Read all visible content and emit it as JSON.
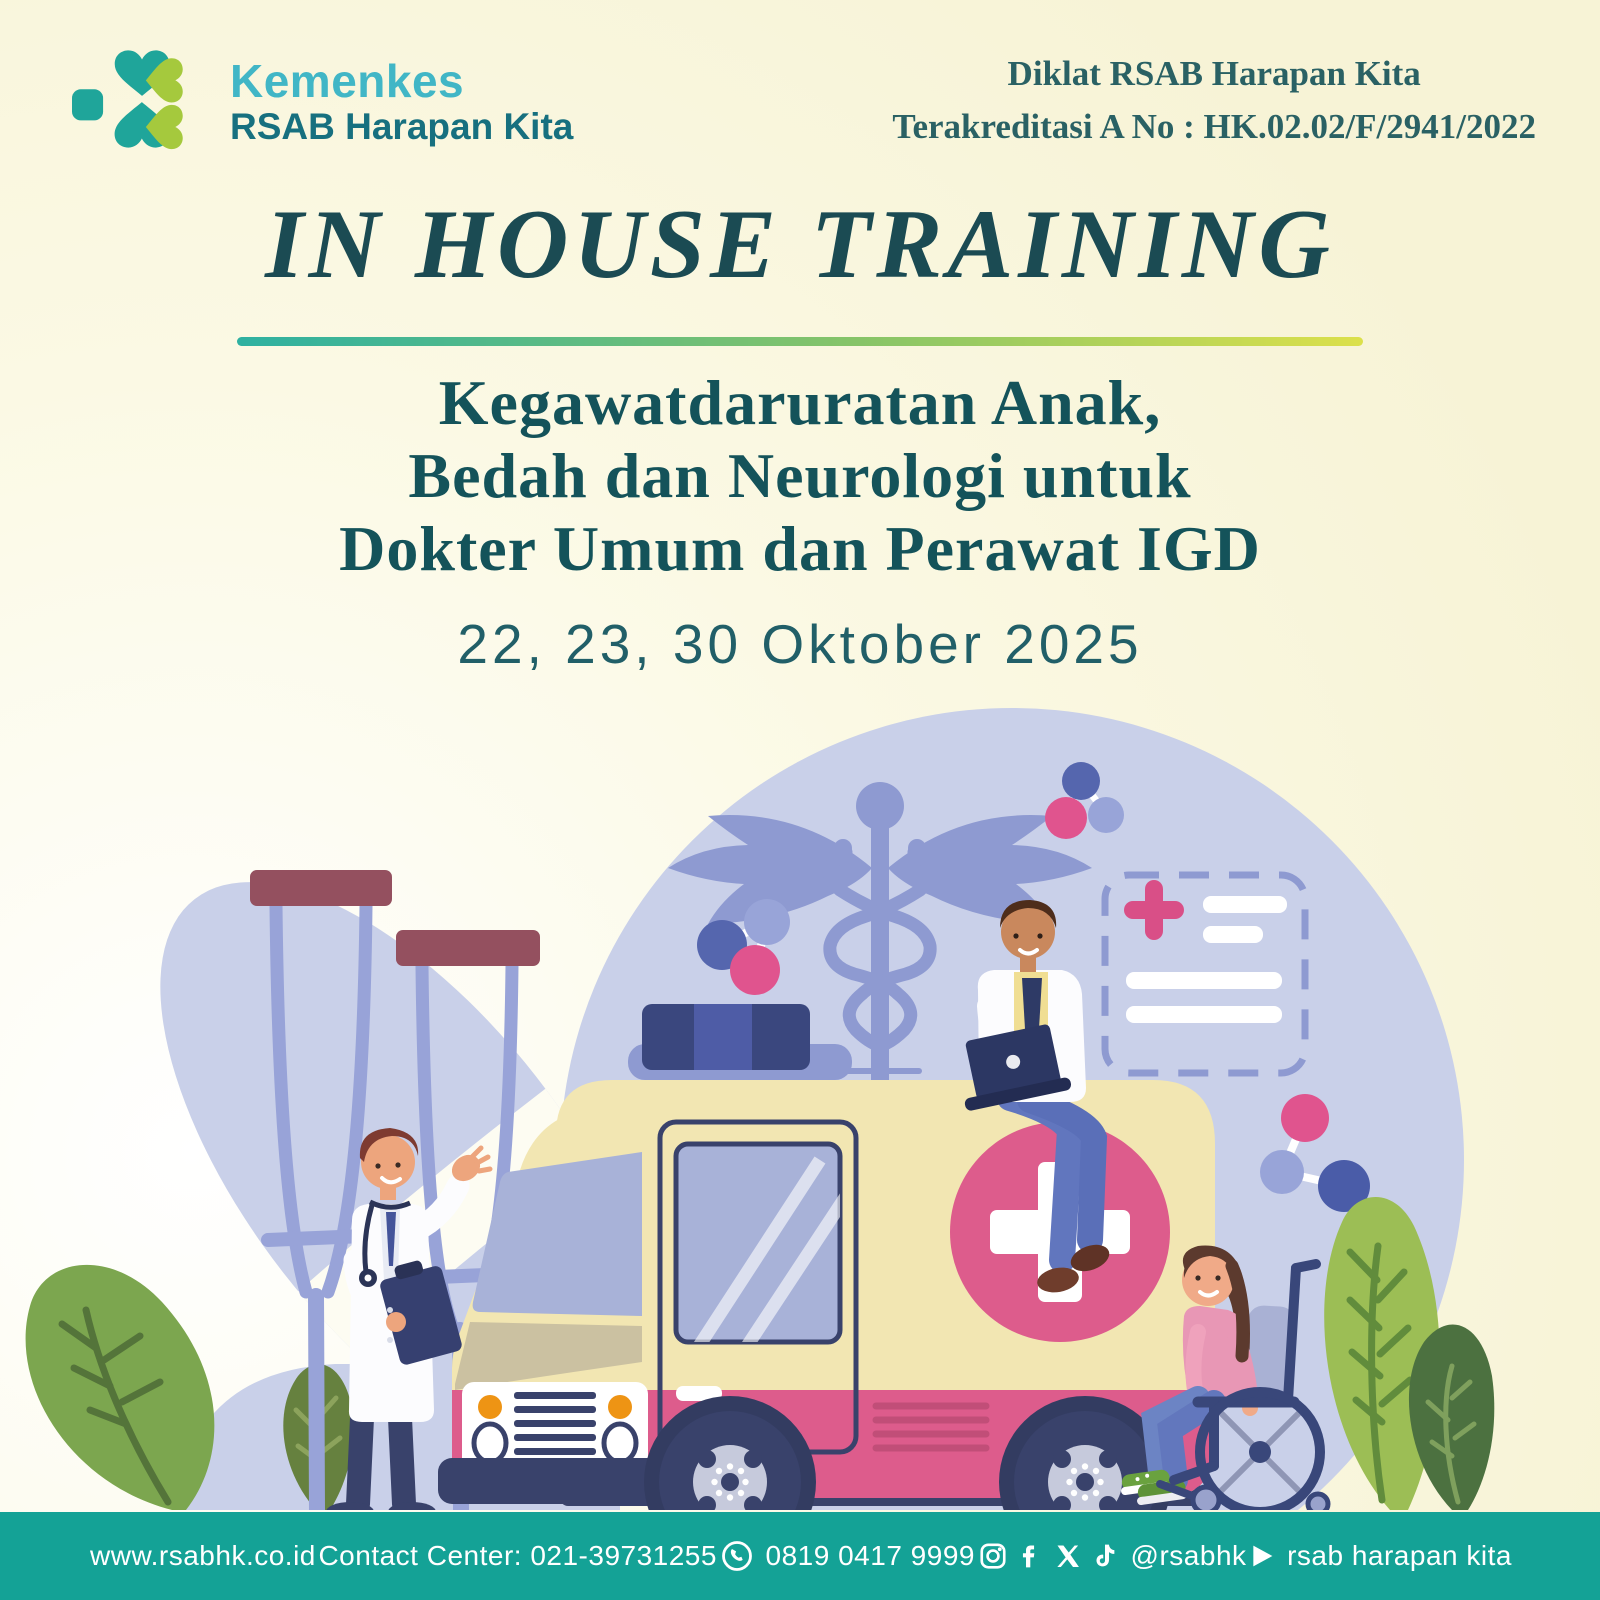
{
  "header": {
    "brand": {
      "line1": "Kemenkes",
      "line2": "RSAB Harapan Kita",
      "logo_icon": "kemenkes-clover-icon"
    },
    "accreditation_line1": "Diklat RSAB Harapan Kita",
    "accreditation_line2": "Terakreditasi A No : HK.02.02/F/2941/2022"
  },
  "title": "IN HOUSE TRAINING",
  "subtitle_lines": [
    "Kegawatdaruratan Anak,",
    "Bedah dan Neurologi untuk",
    "Dokter Umum dan Perawat IGD"
  ],
  "date": "22, 23, 30 Oktober 2025",
  "footer": {
    "website": "www.rsabhk.co.id",
    "contact": "Contact Center: 021-39731255",
    "whatsapp_number": "0819 0417 9999",
    "social_handle": "@rsabhk",
    "youtube_channel": "rsab harapan kita"
  },
  "colors": {
    "brand_teal": "#41B6C6",
    "brand_dark_teal": "#17707F",
    "logo_teal": "#1FA59A",
    "logo_lime": "#A5C93D",
    "title_text": "#1B4B53",
    "subtitle_text": "#14535A",
    "accent_gradient": [
      "#2EB1A1",
      "#86C468",
      "#DCE04B"
    ],
    "footer_background": "#14A296",
    "blob_lavender": "#C9D0E9",
    "caduceus_lavender": "#8E9AD1",
    "ambulance_body": "#F2E6B2",
    "ambulance_pink": "#DD5C8C",
    "ambulance_navy": "#39426B"
  },
  "illustration_icons": [
    "caduceus-icon",
    "ambulance",
    "crutches",
    "wheelchair",
    "medical-note-card",
    "molecule-decorations",
    "plants"
  ]
}
